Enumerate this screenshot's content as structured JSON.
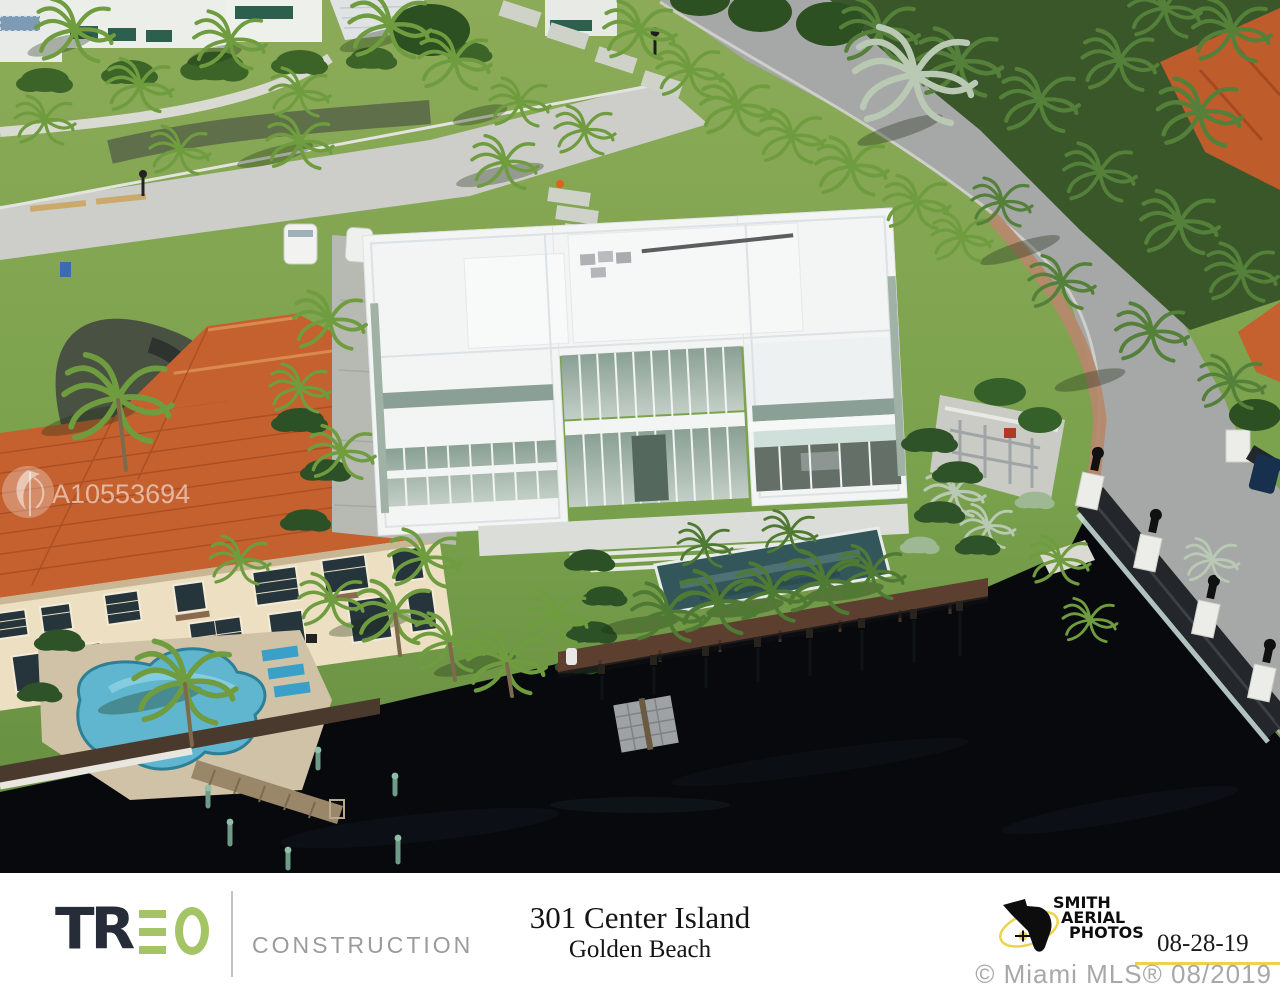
{
  "watermark": {
    "id_text": "A10553694"
  },
  "footer": {
    "brand": {
      "name": "TREO",
      "tr_part": "TR",
      "subtitle": "CONSTRUCTION",
      "accent_color": "#a4c465",
      "dark_color": "#262c38",
      "subtitle_color": "#9b9b9b"
    },
    "property": {
      "address": "301 Center Island",
      "city": "Golden Beach"
    },
    "photographer": {
      "logo_line1": "SMITH",
      "logo_line2": "AERIAL",
      "logo_line3": "PHOTOS",
      "date": "08-28-19",
      "accent_color": "#e9d44c"
    },
    "copyright": "© Miami MLS® 08/2019"
  },
  "scene": {
    "description": "Aerial photo of a waterfront modern white mansion beside a terracotta-roof villa with pool, docks and a lantern-lined bridge over dark water",
    "features": [
      "modern-white-mansion",
      "terracotta-roof-villa",
      "freeform-pool",
      "lap-pool",
      "wood-dock",
      "floating-dock",
      "seawall-boardwalk",
      "bridge-fence-lanterns",
      "curved-road",
      "palm-trees",
      "white-van"
    ],
    "colors": {
      "water": "#07090d",
      "lawn": "#85a854",
      "lawn_dark": "#5a8038",
      "road": "#a6a8a7",
      "street": "#cdcec9",
      "roof_terracotta": "#c4612f",
      "mansion_white": "#f3f5f4",
      "glass": "#9db0a3",
      "pool_blue": "#5fb6ce",
      "lap_pool": "#32565a",
      "boardwalk_dark": "#4a3a2e",
      "dock_red_brown": "#5d3f30",
      "brick": "#b5886b",
      "cream_wall": "#ecdfc2"
    }
  }
}
